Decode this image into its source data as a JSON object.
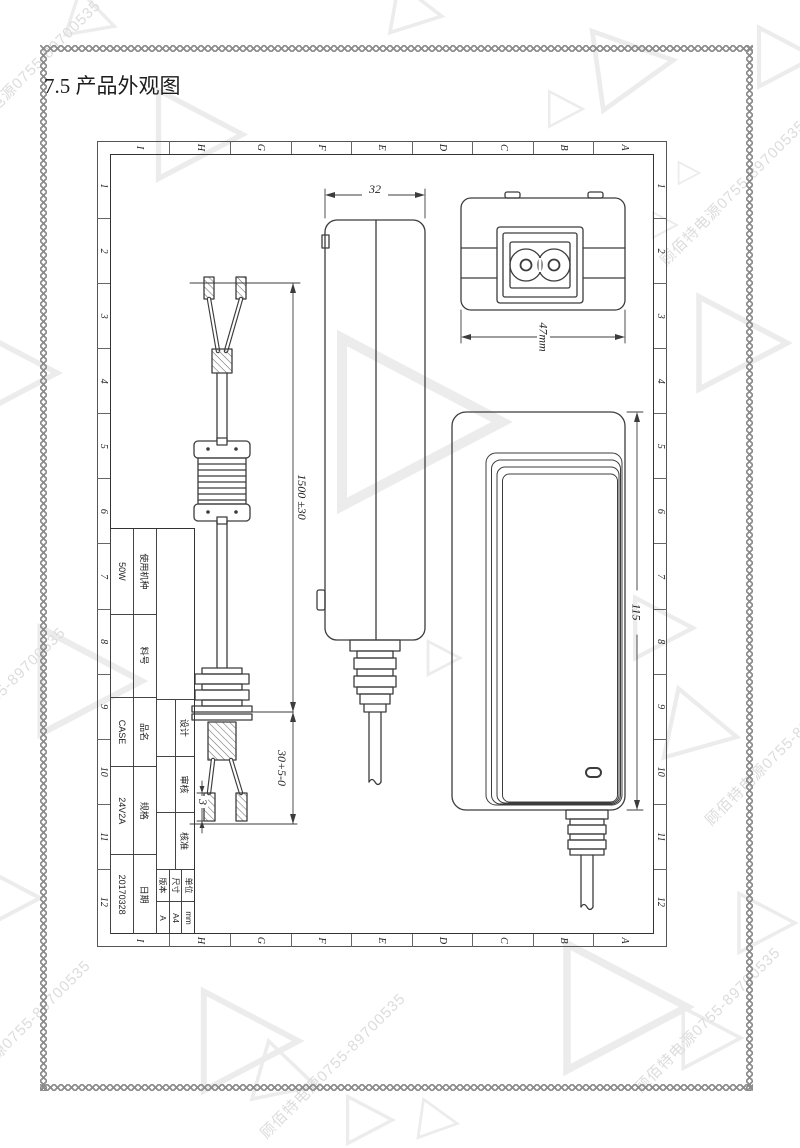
{
  "page": {
    "section_title": "7.5 产品外观图",
    "watermark": "顾佰特电源0755-89700535"
  },
  "sheet": {
    "grid_numbers": [
      "1",
      "2",
      "3",
      "4",
      "5",
      "6",
      "7",
      "8",
      "9",
      "10",
      "11",
      "12"
    ],
    "grid_letters": [
      "A",
      "B",
      "C",
      "D",
      "E",
      "F",
      "G",
      "H",
      "I"
    ],
    "title_block": {
      "approvals": [
        {
          "label": "设计",
          "value": ""
        },
        {
          "label": "审核",
          "value": ""
        },
        {
          "label": "核准",
          "value": ""
        }
      ],
      "meta": [
        {
          "label": "单位",
          "value": "mm"
        },
        {
          "label": "尺寸",
          "value": "A4"
        },
        {
          "label": "版本",
          "value": "A"
        }
      ],
      "fields": [
        {
          "label": "使用机种",
          "value": "50W"
        },
        {
          "label": "料号",
          "value": ""
        },
        {
          "label": "品名",
          "value": "CASE"
        },
        {
          "label": "规格",
          "value": "24V2A"
        },
        {
          "label": "日期",
          "value": "20170328"
        }
      ]
    },
    "dimensions": {
      "adapter_thickness": "32",
      "adapter_width": "47mm",
      "adapter_length": "115",
      "cable_length": "1500 ±30",
      "strip_length": "30+5-0",
      "tin_length": "3"
    }
  }
}
